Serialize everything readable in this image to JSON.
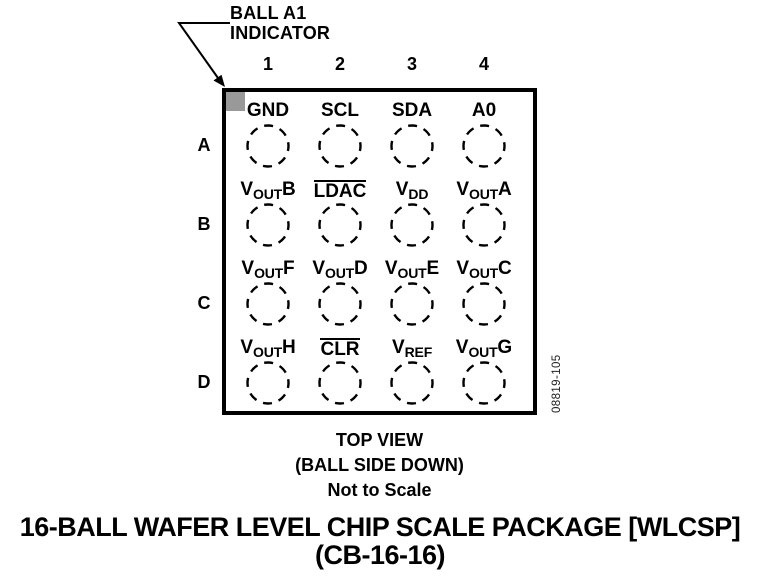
{
  "colors": {
    "ink": "#000000",
    "indicator_gray": "#999999"
  },
  "callout": {
    "line1": "BALL A1",
    "line2": "INDICATOR"
  },
  "package": {
    "columns": [
      "1",
      "2",
      "3",
      "4"
    ],
    "rows": [
      "A",
      "B",
      "C",
      "D"
    ],
    "pins": [
      [
        {
          "base": "GND"
        },
        {
          "base": "SCL"
        },
        {
          "base": "SDA"
        },
        {
          "base": "A0"
        }
      ],
      [
        {
          "base": "V",
          "sub": "OUT",
          "post": "B"
        },
        {
          "base": "LDAC",
          "overline": true
        },
        {
          "base": "V",
          "sub": "DD"
        },
        {
          "base": "V",
          "sub": "OUT",
          "post": "A"
        }
      ],
      [
        {
          "base": "V",
          "sub": "OUT",
          "post": "F"
        },
        {
          "base": "V",
          "sub": "OUT",
          "post": "D"
        },
        {
          "base": "V",
          "sub": "OUT",
          "post": "E"
        },
        {
          "base": "V",
          "sub": "OUT",
          "post": "C"
        }
      ],
      [
        {
          "base": "V",
          "sub": "OUT",
          "post": "H"
        },
        {
          "base": "CLR",
          "overline": true
        },
        {
          "base": "V",
          "sub": "REF"
        },
        {
          "base": "V",
          "sub": "OUT",
          "post": "G"
        }
      ]
    ]
  },
  "view_notes": {
    "line1": "TOP VIEW",
    "line2": "(BALL SIDE DOWN)",
    "line3": "Not to Scale"
  },
  "figure_number": "08819-105",
  "caption": {
    "line1": "16-BALL WAFER LEVEL CHIP SCALE PACKAGE [WLCSP]",
    "line2": "(CB-16-16)"
  }
}
